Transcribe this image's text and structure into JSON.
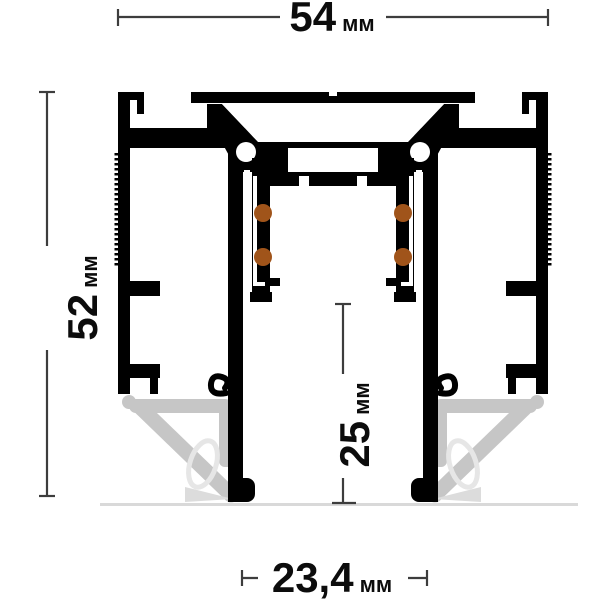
{
  "figure": {
    "type": "technical-drawing",
    "subject": "recessed-magnetic-track-profile-cross-section",
    "unit_system": "metric"
  },
  "dimensions": {
    "overall_width": {
      "value": "54",
      "unit": "мм",
      "orientation": "horizontal",
      "position": "top"
    },
    "overall_height": {
      "value": "52",
      "unit": "мм",
      "orientation": "vertical",
      "position": "left"
    },
    "channel_depth": {
      "value": "25",
      "unit": "мм",
      "orientation": "vertical",
      "position": "center"
    },
    "channel_width": {
      "value": "23,4",
      "unit": "мм",
      "orientation": "horizontal",
      "position": "bottom"
    }
  },
  "features": {
    "contact_dots_per_side": 2,
    "mounting_clips": 2
  },
  "colors": {
    "profile": "#000000",
    "contacts": "#a0541a",
    "spring_clip": "#c6c6c6",
    "spring_clip_light": "#e6e6e6",
    "dimension_lines": "#3d3d3d",
    "baseline": "#d9d9d9",
    "background": "#ffffff"
  }
}
